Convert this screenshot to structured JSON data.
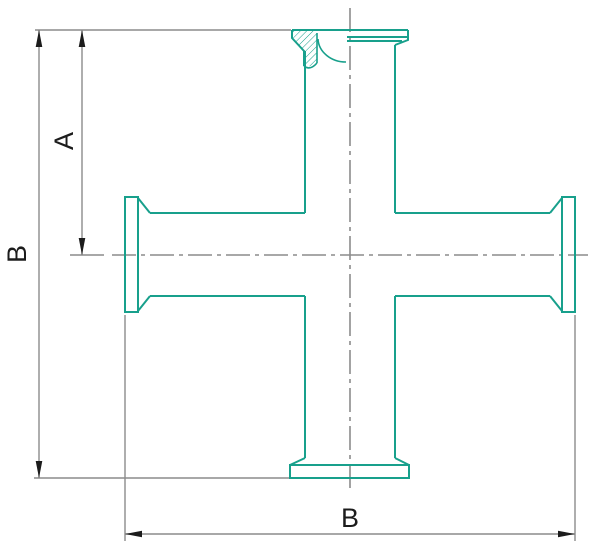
{
  "labels": {
    "a": "A",
    "b_vertical": "B",
    "b_horizontal": "B"
  },
  "colors": {
    "outline": "#18a08c",
    "line_gray": "#8c8c8c",
    "dimension_black": "#1c1c1c",
    "background": "#ffffff"
  }
}
